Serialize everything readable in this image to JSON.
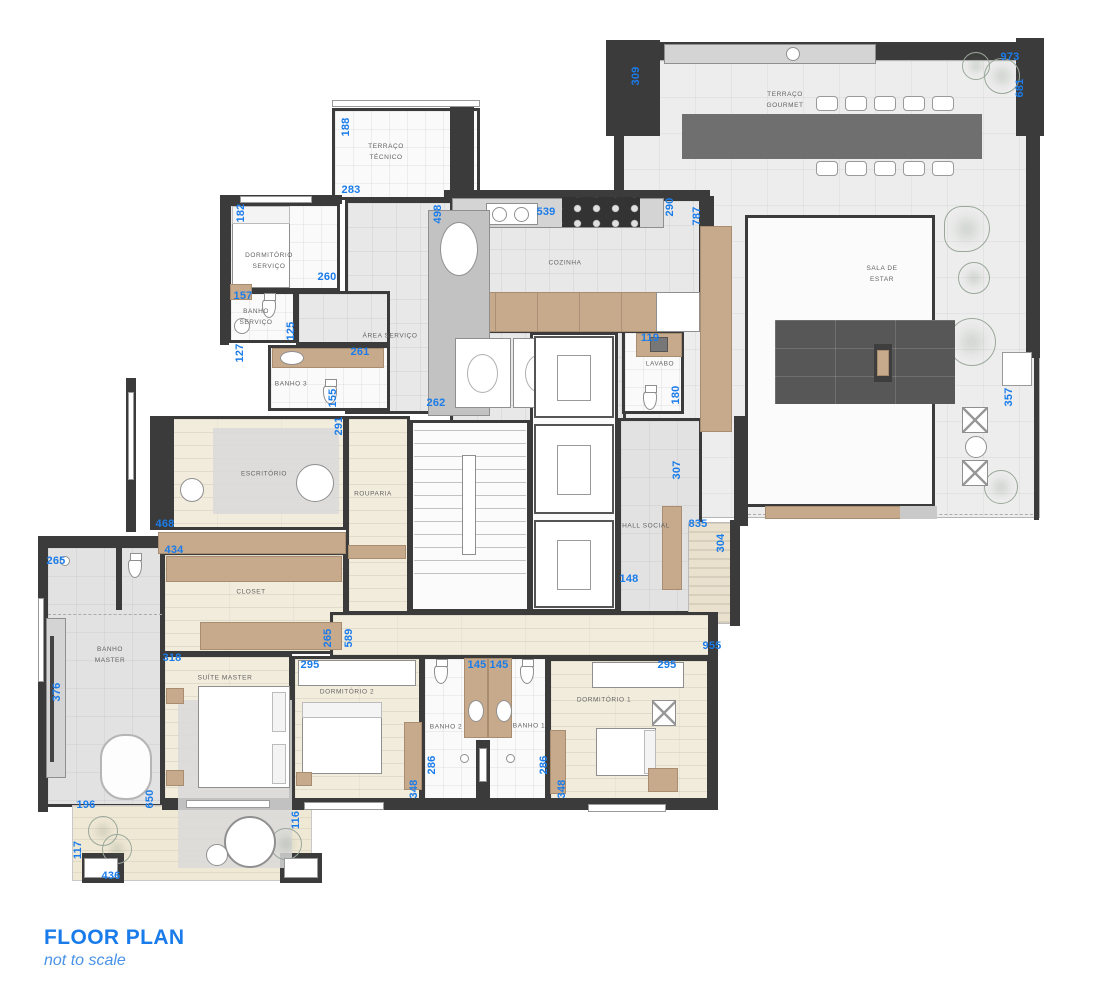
{
  "title": {
    "heading": "FLOOR PLAN",
    "subheading": "not to scale"
  },
  "colors": {
    "dimension_blue": "#1a7cea",
    "wall_dark": "#3b3b3b",
    "cabinet_tan": "#c7a98c",
    "floor_wood": "#f2ecdc",
    "floor_tile": "#e8e8e8"
  },
  "rooms": [
    {
      "id": "terraco-gourmet",
      "label": "TERRAÇO\nGOURMET",
      "lx": 785,
      "ly": 100,
      "x": 622,
      "y": 60,
      "w": 418,
      "h": 458,
      "floor": "terrace"
    },
    {
      "id": "sala-de-estar",
      "label": "SALA DE\nESTAR",
      "lx": 882,
      "ly": 274,
      "x": 745,
      "y": 215,
      "w": 190,
      "h": 292,
      "floor": "white"
    },
    {
      "id": "terraco-tecnico",
      "label": "TERRAÇO\nTÉCNICO",
      "lx": 386,
      "ly": 152,
      "x": 332,
      "y": 108,
      "w": 148,
      "h": 92,
      "floor": "whitegrid"
    },
    {
      "id": "area-servico",
      "label": "ÁREA SERVIÇO",
      "lx": 390,
      "ly": 336,
      "x": 345,
      "y": 200,
      "w": 108,
      "h": 214,
      "floor": "tile"
    },
    {
      "id": "cozinha",
      "label": "COZINHA",
      "lx": 565,
      "ly": 263,
      "x": 450,
      "y": 198,
      "w": 252,
      "h": 134,
      "floor": "tile"
    },
    {
      "id": "servico-hall",
      "label": "",
      "lx": 0,
      "ly": 0,
      "x": 450,
      "y": 330,
      "w": 176,
      "h": 94,
      "floor": "tile"
    },
    {
      "id": "dormitorio-servico",
      "label": "DORMITÓRIO\nSERVIÇO",
      "lx": 269,
      "ly": 261,
      "x": 228,
      "y": 203,
      "w": 112,
      "h": 88,
      "floor": "whitegrid"
    },
    {
      "id": "banho-servico",
      "label": "BANHO\nSERVIÇO",
      "lx": 256,
      "ly": 317,
      "x": 228,
      "y": 291,
      "w": 68,
      "h": 52,
      "floor": "whitegrid"
    },
    {
      "id": "corredor-servico",
      "label": "",
      "lx": 0,
      "ly": 0,
      "x": 296,
      "y": 291,
      "w": 94,
      "h": 54,
      "floor": "tile"
    },
    {
      "id": "banho-3",
      "label": "BANHO 3",
      "lx": 291,
      "ly": 384,
      "x": 268,
      "y": 345,
      "w": 122,
      "h": 66,
      "floor": "whitegrid"
    },
    {
      "id": "escritorio",
      "label": "ESCRITÓRIO",
      "lx": 264,
      "ly": 474,
      "x": 150,
      "y": 416,
      "w": 196,
      "h": 114,
      "floor": "wood"
    },
    {
      "id": "rouparia",
      "label": "ROUPARIA",
      "lx": 373,
      "ly": 494,
      "x": 346,
      "y": 416,
      "w": 64,
      "h": 198,
      "floor": "wood"
    },
    {
      "id": "escada",
      "label": "",
      "lx": 0,
      "ly": 0,
      "x": 410,
      "y": 420,
      "w": 120,
      "h": 192,
      "floor": "white"
    },
    {
      "id": "elevadores",
      "label": "",
      "lx": 0,
      "ly": 0,
      "x": 530,
      "y": 332,
      "w": 88,
      "h": 280,
      "floor": "white"
    },
    {
      "id": "lavabo",
      "label": "LAVABO",
      "lx": 660,
      "ly": 364,
      "x": 622,
      "y": 330,
      "w": 62,
      "h": 84,
      "floor": "whitegrid"
    },
    {
      "id": "hall-social",
      "label": "HALL SOCIAL",
      "lx": 646,
      "ly": 526,
      "x": 618,
      "y": 418,
      "w": 84,
      "h": 196,
      "floor": "graytile"
    },
    {
      "id": "hall-entrada",
      "label": "",
      "lx": 0,
      "ly": 0,
      "x": 688,
      "y": 522,
      "w": 48,
      "h": 102,
      "floor": "hatch"
    },
    {
      "id": "closet",
      "label": "CLOSET",
      "lx": 251,
      "ly": 592,
      "x": 162,
      "y": 552,
      "w": 184,
      "h": 102,
      "floor": "wood"
    },
    {
      "id": "banho-master",
      "label": "BANHO\nMASTER",
      "lx": 110,
      "ly": 655,
      "x": 45,
      "y": 545,
      "w": 118,
      "h": 262,
      "floor": "graytile"
    },
    {
      "id": "corredor",
      "label": "",
      "lx": 0,
      "ly": 0,
      "x": 330,
      "y": 612,
      "w": 388,
      "h": 46,
      "floor": "wood"
    },
    {
      "id": "suite-master",
      "label": "SUÍTE MASTER",
      "lx": 225,
      "ly": 678,
      "x": 162,
      "y": 654,
      "w": 130,
      "h": 150,
      "floor": "wood"
    },
    {
      "id": "dormitorio-2",
      "label": "DORMITÓRIO 2",
      "lx": 347,
      "ly": 692,
      "x": 292,
      "y": 656,
      "w": 130,
      "h": 148,
      "floor": "wood"
    },
    {
      "id": "banhos-block",
      "label": "",
      "lx": 0,
      "ly": 0,
      "x": 422,
      "y": 656,
      "w": 126,
      "h": 148,
      "floor": "whitegrid"
    },
    {
      "id": "banho-2",
      "label": "BANHO 2",
      "lx": 446,
      "ly": 727,
      "x": 0,
      "y": 0,
      "w": 1,
      "h": 1,
      "floor": "none"
    },
    {
      "id": "banho-1",
      "label": "BANHO 1",
      "lx": 529,
      "ly": 726,
      "x": 0,
      "y": 0,
      "w": 1,
      "h": 1,
      "floor": "none"
    },
    {
      "id": "dormitorio-1",
      "label": "DORMITÓRIO 1",
      "lx": 604,
      "ly": 700,
      "x": 548,
      "y": 658,
      "w": 162,
      "h": 150,
      "floor": "wood"
    },
    {
      "id": "terraco-master",
      "label": "",
      "lx": 0,
      "ly": 0,
      "x": 72,
      "y": 805,
      "w": 240,
      "h": 76,
      "floor": "deck"
    }
  ],
  "dimensions": [
    {
      "v": "973",
      "x": 1010,
      "y": 57,
      "o": "h"
    },
    {
      "v": "681",
      "x": 1020,
      "y": 88,
      "o": "v"
    },
    {
      "v": "309",
      "x": 636,
      "y": 76,
      "o": "v"
    },
    {
      "v": "188",
      "x": 346,
      "y": 127,
      "o": "v"
    },
    {
      "v": "283",
      "x": 351,
      "y": 190,
      "o": "h"
    },
    {
      "v": "182",
      "x": 241,
      "y": 213,
      "o": "v"
    },
    {
      "v": "498",
      "x": 438,
      "y": 214,
      "o": "v"
    },
    {
      "v": "539",
      "x": 546,
      "y": 212,
      "o": "h"
    },
    {
      "v": "290",
      "x": 670,
      "y": 207,
      "o": "v"
    },
    {
      "v": "787",
      "x": 697,
      "y": 216,
      "o": "v"
    },
    {
      "v": "260",
      "x": 327,
      "y": 277,
      "o": "h"
    },
    {
      "v": "157",
      "x": 243,
      "y": 296,
      "o": "h"
    },
    {
      "v": "125",
      "x": 291,
      "y": 331,
      "o": "v"
    },
    {
      "v": "127",
      "x": 240,
      "y": 353,
      "o": "v"
    },
    {
      "v": "261",
      "x": 360,
      "y": 352,
      "o": "h"
    },
    {
      "v": "119",
      "x": 650,
      "y": 338,
      "o": "h"
    },
    {
      "v": "155",
      "x": 333,
      "y": 398,
      "o": "v"
    },
    {
      "v": "180",
      "x": 676,
      "y": 395,
      "o": "v"
    },
    {
      "v": "262",
      "x": 436,
      "y": 403,
      "o": "h"
    },
    {
      "v": "291",
      "x": 339,
      "y": 426,
      "o": "v"
    },
    {
      "v": "307",
      "x": 677,
      "y": 470,
      "o": "v"
    },
    {
      "v": "357",
      "x": 1009,
      "y": 397,
      "o": "v"
    },
    {
      "v": "468",
      "x": 165,
      "y": 524,
      "o": "h"
    },
    {
      "v": "835",
      "x": 698,
      "y": 524,
      "o": "h"
    },
    {
      "v": "304",
      "x": 721,
      "y": 543,
      "o": "v"
    },
    {
      "v": "434",
      "x": 174,
      "y": 550,
      "o": "h"
    },
    {
      "v": "265",
      "x": 56,
      "y": 561,
      "o": "h"
    },
    {
      "v": "148",
      "x": 629,
      "y": 579,
      "o": "h"
    },
    {
      "v": "265",
      "x": 328,
      "y": 638,
      "o": "v"
    },
    {
      "v": "589",
      "x": 349,
      "y": 638,
      "o": "v"
    },
    {
      "v": "955",
      "x": 712,
      "y": 646,
      "o": "h"
    },
    {
      "v": "318",
      "x": 172,
      "y": 658,
      "o": "h"
    },
    {
      "v": "295",
      "x": 310,
      "y": 665,
      "o": "h"
    },
    {
      "v": "145",
      "x": 477,
      "y": 665,
      "o": "h"
    },
    {
      "v": "145",
      "x": 499,
      "y": 665,
      "o": "h"
    },
    {
      "v": "295",
      "x": 667,
      "y": 665,
      "o": "h"
    },
    {
      "v": "376",
      "x": 57,
      "y": 692,
      "o": "v"
    },
    {
      "v": "286",
      "x": 432,
      "y": 765,
      "o": "v"
    },
    {
      "v": "286",
      "x": 544,
      "y": 765,
      "o": "v"
    },
    {
      "v": "348",
      "x": 414,
      "y": 789,
      "o": "v"
    },
    {
      "v": "348",
      "x": 562,
      "y": 789,
      "o": "v"
    },
    {
      "v": "650",
      "x": 150,
      "y": 799,
      "o": "v"
    },
    {
      "v": "196",
      "x": 86,
      "y": 805,
      "o": "h"
    },
    {
      "v": "116",
      "x": 296,
      "y": 820,
      "o": "v"
    },
    {
      "v": "117",
      "x": 78,
      "y": 850,
      "o": "v"
    },
    {
      "v": "436",
      "x": 111,
      "y": 876,
      "o": "h"
    }
  ]
}
